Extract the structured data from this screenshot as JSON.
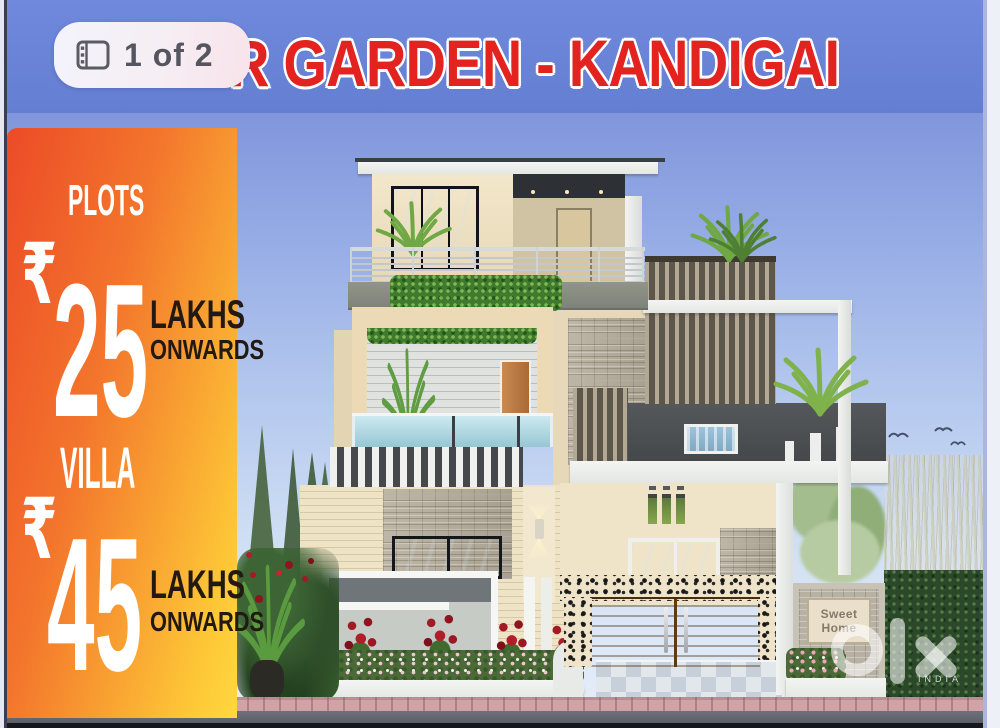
{
  "pager": {
    "label": "1 of 2",
    "icon": "gallery-icon"
  },
  "banner": {
    "title": "R GARDEN - KANDIGAI",
    "bg": "#6b84d8",
    "title_color": "#e2231f"
  },
  "sidebar": {
    "bg_from": "#ec4b27",
    "bg_to": "#ffd83e",
    "offers": [
      {
        "category": "PLOTS",
        "currency": "₹",
        "amount": "25",
        "unit": "LAKHS",
        "note": "ONWARDS"
      },
      {
        "category": "VILLA",
        "currency": "₹",
        "amount": "45",
        "unit": "LAKHS",
        "note": "ONWARDS"
      }
    ]
  },
  "house": {
    "nameplate_line1": "Sweet",
    "nameplate_line2": "Home"
  },
  "watermark": {
    "brand": "olx",
    "country": "INDIA"
  }
}
